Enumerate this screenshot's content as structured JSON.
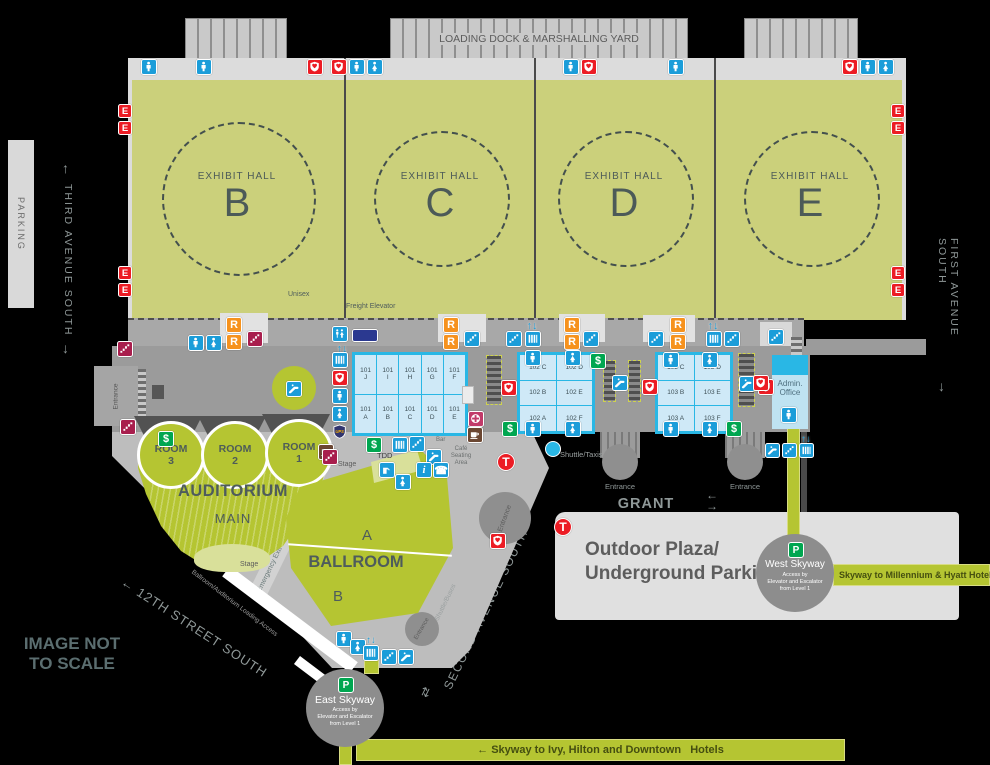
{
  "colors": {
    "blue": "#1b9dd9",
    "orange": "#f6921e",
    "red": "#ec1c24",
    "green": "#00a650",
    "maroon": "#a81e4d",
    "navy": "#2b3990",
    "pink": "#c13a69",
    "brown": "#6b4732",
    "cyan": "#29b7e5",
    "hall_green": "#cbd07b",
    "bright_green": "#b5c532"
  },
  "loading_dock": {
    "label": "LOADING DOCK & MARSHALLING YARD"
  },
  "exhibit_halls": [
    {
      "label": "EXHIBIT HALL",
      "letter": "B"
    },
    {
      "label": "EXHIBIT HALL",
      "letter": "C"
    },
    {
      "label": "EXHIBIT HALL",
      "letter": "D"
    },
    {
      "label": "EXHIBIT HALL",
      "letter": "E"
    }
  ],
  "streets": {
    "parking": "PARKING",
    "third_ave": "THIRD AVENUE SOUTH",
    "first_ave": "FIRST AVENUE SOUTH",
    "second_ave": "SECOND AVENUE SOUTH",
    "grant": "GRANT STREET",
    "twelfth": "← 12TH STREET SOUTH",
    "not_to_scale": "IMAGE NOT\nTO SCALE",
    "up_arrow": "↑",
    "down_arrow": "↓",
    "left_arrow": "←",
    "right_arrow": "→",
    "both_arrows": "⇄"
  },
  "labels": {
    "unisex": "Unisex",
    "freight_elevator": "Freight Elevator",
    "tdd": "TDD",
    "bar": "Bar",
    "cafe": "Café\nSeating\nArea",
    "shuttle_taxis": "Shuttle/Taxis",
    "shuttle_buses": "Shuttle/Buses",
    "entrance": "Entrance",
    "stage": "Stage",
    "emergency_corridor": "Emergency Exit Corridor",
    "loading_access": "Ballroom/Auditorium Loading Access",
    "outdoor_plaza": "Outdoor Plaza/\nUnderground Parking"
  },
  "auditorium": {
    "title": "AUDITORIUM",
    "subtitle": "MAIN",
    "rooms": [
      {
        "line1": "ROOM",
        "line2": "3"
      },
      {
        "line1": "ROOM",
        "line2": "2"
      },
      {
        "line1": "ROOM",
        "line2": "1"
      }
    ]
  },
  "ballroom": {
    "a": "A",
    "title": "BALLROOM",
    "b": "B"
  },
  "admin": {
    "name": "Admin.\nOffice"
  },
  "meeting_rooms": {
    "block101": {
      "top": [
        "101 J",
        "101 I",
        "101 H",
        "101 G",
        "101 F"
      ],
      "bottom": [
        "101 A",
        "101 B",
        "101 C",
        "101 D",
        "101 E"
      ]
    },
    "block102": {
      "rows": [
        [
          "102 C",
          "102 D"
        ],
        [
          "102 B",
          "102 E"
        ],
        [
          "102 A",
          "102 F"
        ]
      ]
    },
    "block103": {
      "rows": [
        [
          "103 C",
          "103 D"
        ],
        [
          "103 B",
          "103 E"
        ],
        [
          "103 A",
          "103 F"
        ]
      ]
    }
  },
  "skyways": {
    "west": {
      "p": "P",
      "name": "West Skyway",
      "access": "Access by\nElevator and Escalator\nfrom Level 1",
      "band": "Skyway to Millennium & Hyatt Hotels"
    },
    "east": {
      "p": "P",
      "name": "East Skyway",
      "access": "Access by\nElevator and Escalator\nfrom Level 1",
      "band": "← Skyway to Ivy, Hilton and Downtown   Hotels"
    }
  },
  "icons": [
    {
      "t": "men",
      "x": 141,
      "y": 59
    },
    {
      "t": "men",
      "x": 196,
      "y": 59
    },
    {
      "t": "aed",
      "x": 307,
      "y": 59
    },
    {
      "t": "aed",
      "x": 331,
      "y": 59
    },
    {
      "t": "men",
      "x": 349,
      "y": 59
    },
    {
      "t": "women",
      "x": 367,
      "y": 59
    },
    {
      "t": "men",
      "x": 563,
      "y": 59
    },
    {
      "t": "aed",
      "x": 581,
      "y": 59
    },
    {
      "t": "men",
      "x": 668,
      "y": 59
    },
    {
      "t": "aed",
      "x": 842,
      "y": 59
    },
    {
      "t": "men",
      "x": 860,
      "y": 59
    },
    {
      "t": "women",
      "x": 878,
      "y": 59
    },
    {
      "t": "exit",
      "x": 118,
      "y": 104,
      "s": 14
    },
    {
      "t": "exit",
      "x": 118,
      "y": 121,
      "s": 14
    },
    {
      "t": "exit",
      "x": 118,
      "y": 266,
      "s": 14
    },
    {
      "t": "exit",
      "x": 118,
      "y": 283,
      "s": 14
    },
    {
      "t": "exit",
      "x": 891,
      "y": 104,
      "s": 14
    },
    {
      "t": "exit",
      "x": 891,
      "y": 121,
      "s": 14
    },
    {
      "t": "exit",
      "x": 891,
      "y": 266,
      "s": 14
    },
    {
      "t": "exit",
      "x": 891,
      "y": 283,
      "s": 14
    },
    {
      "t": "stairsx",
      "x": 117,
      "y": 341
    },
    {
      "t": "men",
      "x": 188,
      "y": 335
    },
    {
      "t": "women",
      "x": 206,
      "y": 335
    },
    {
      "t": "recycle",
      "x": 226,
      "y": 317
    },
    {
      "t": "recycle",
      "x": 226,
      "y": 334
    },
    {
      "t": "stairsx",
      "x": 247,
      "y": 331
    },
    {
      "t": "recycle",
      "x": 443,
      "y": 317
    },
    {
      "t": "recycle",
      "x": 443,
      "y": 334
    },
    {
      "t": "stairs",
      "x": 464,
      "y": 331
    },
    {
      "t": "stairs",
      "x": 506,
      "y": 331
    },
    {
      "t": "updown",
      "x": 524,
      "y": 318
    },
    {
      "t": "elev",
      "x": 525,
      "y": 331
    },
    {
      "t": "recycle",
      "x": 564,
      "y": 317
    },
    {
      "t": "recycle",
      "x": 564,
      "y": 334
    },
    {
      "t": "stairs",
      "x": 583,
      "y": 331
    },
    {
      "t": "stairs",
      "x": 648,
      "y": 331
    },
    {
      "t": "recycle",
      "x": 670,
      "y": 317
    },
    {
      "t": "recycle",
      "x": 670,
      "y": 334
    },
    {
      "t": "updown",
      "x": 705,
      "y": 318
    },
    {
      "t": "elev",
      "x": 706,
      "y": 331
    },
    {
      "t": "stairs",
      "x": 724,
      "y": 331
    },
    {
      "t": "stairs",
      "x": 768,
      "y": 329
    },
    {
      "t": "unisex",
      "x": 332,
      "y": 326
    },
    {
      "t": "updown",
      "x": 334,
      "y": 341
    },
    {
      "t": "elev",
      "x": 332,
      "y": 352
    },
    {
      "t": "aed",
      "x": 332,
      "y": 370
    },
    {
      "t": "men",
      "x": 332,
      "y": 388
    },
    {
      "t": "women",
      "x": 332,
      "y": 406
    },
    {
      "t": "ups",
      "x": 330,
      "y": 422,
      "s": 19
    },
    {
      "t": "freight",
      "x": 352,
      "y": 329,
      "w": 26,
      "h": 13
    },
    {
      "t": "esc",
      "x": 286,
      "y": 381
    },
    {
      "t": "men",
      "x": 525,
      "y": 350
    },
    {
      "t": "women",
      "x": 565,
      "y": 350
    },
    {
      "t": "men",
      "x": 525,
      "y": 421
    },
    {
      "t": "women",
      "x": 565,
      "y": 421
    },
    {
      "t": "atm",
      "x": 590,
      "y": 353
    },
    {
      "t": "atm",
      "x": 502,
      "y": 421
    },
    {
      "t": "aed",
      "x": 501,
      "y": 380
    },
    {
      "t": "esc",
      "x": 612,
      "y": 375
    },
    {
      "t": "men",
      "x": 663,
      "y": 352
    },
    {
      "t": "women",
      "x": 702,
      "y": 352
    },
    {
      "t": "men",
      "x": 663,
      "y": 421
    },
    {
      "t": "women",
      "x": 702,
      "y": 421
    },
    {
      "t": "aed",
      "x": 642,
      "y": 379
    },
    {
      "t": "esc",
      "x": 739,
      "y": 376
    },
    {
      "t": "aed",
      "x": 758,
      "y": 379
    },
    {
      "t": "atm",
      "x": 726,
      "y": 421
    },
    {
      "t": "aed",
      "x": 753,
      "y": 375
    },
    {
      "t": "men",
      "x": 781,
      "y": 407,
      "n": "admin-elevator-icon"
    },
    {
      "t": "esc",
      "x": 765,
      "y": 443,
      "s": 15
    },
    {
      "t": "stairs",
      "x": 782,
      "y": 443,
      "s": 15
    },
    {
      "t": "updown",
      "x": 799,
      "y": 432,
      "s": 14
    },
    {
      "t": "elev",
      "x": 799,
      "y": 443,
      "s": 15
    },
    {
      "t": "coffee",
      "x": 318,
      "y": 444
    },
    {
      "t": "atm",
      "x": 366,
      "y": 437
    },
    {
      "t": "elev",
      "x": 392,
      "y": 437
    },
    {
      "t": "stairs",
      "x": 409,
      "y": 436
    },
    {
      "t": "esc",
      "x": 426,
      "y": 449
    },
    {
      "t": "fountain",
      "x": 379,
      "y": 462
    },
    {
      "t": "info",
      "x": 416,
      "y": 462
    },
    {
      "t": "phone",
      "x": 433,
      "y": 462
    },
    {
      "t": "women",
      "x": 395,
      "y": 474
    },
    {
      "t": "atm",
      "x": 158,
      "y": 431
    },
    {
      "t": "firstaid",
      "x": 468,
      "y": 411
    },
    {
      "t": "coffee",
      "x": 467,
      "y": 427
    },
    {
      "t": "aed",
      "x": 490,
      "y": 533
    },
    {
      "t": "men",
      "x": 336,
      "y": 631
    },
    {
      "t": "women",
      "x": 350,
      "y": 639
    },
    {
      "t": "updown",
      "x": 364,
      "y": 633,
      "s": 14
    },
    {
      "t": "elev",
      "x": 363,
      "y": 645
    },
    {
      "t": "stairs",
      "x": 381,
      "y": 649
    },
    {
      "t": "esc",
      "x": 398,
      "y": 649
    },
    {
      "t": "stairsx",
      "x": 120,
      "y": 419
    },
    {
      "t": "stairsx",
      "x": 322,
      "y": 449
    },
    {
      "t": "metro",
      "x": 497,
      "y": 453,
      "s": 18
    },
    {
      "t": "metro",
      "x": 554,
      "y": 518,
      "s": 18
    },
    {
      "t": "dot",
      "x": 545,
      "y": 441,
      "s": 16
    }
  ]
}
